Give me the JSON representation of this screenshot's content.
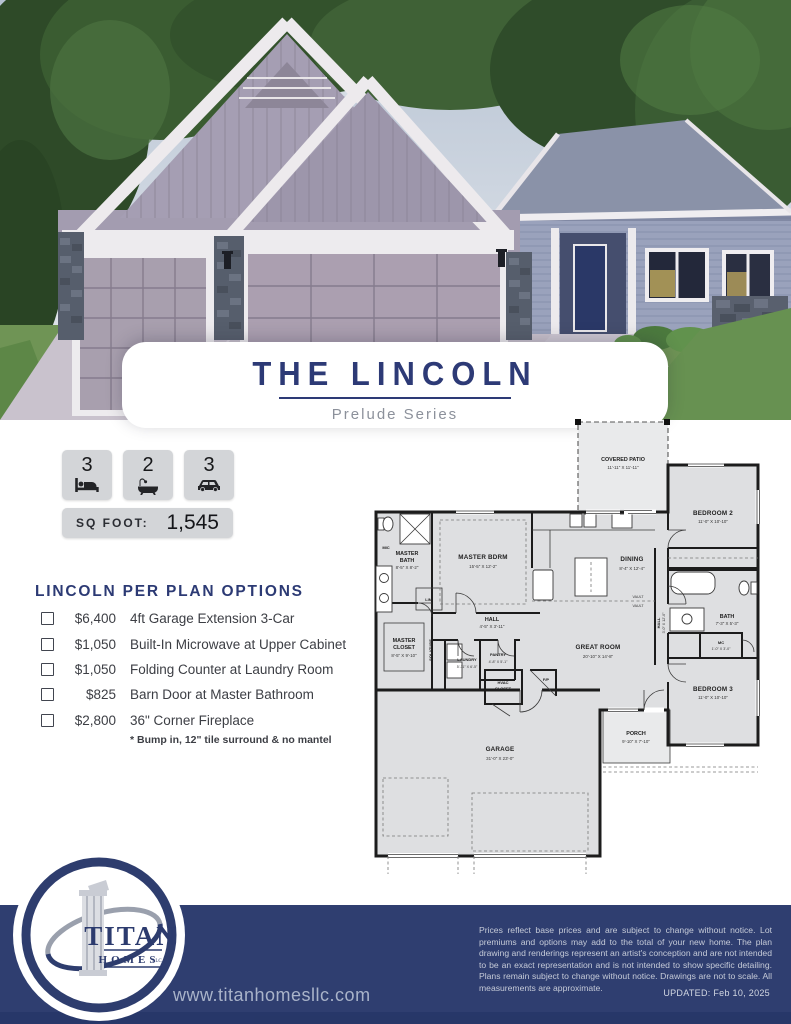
{
  "flyer": {
    "title": "THE LINCOLN",
    "series": "Prelude Series"
  },
  "stats": {
    "beds": "3",
    "baths": "2",
    "garage": "3",
    "beds_icon": "bed-icon",
    "baths_icon": "bath-icon",
    "garage_icon": "car-icon",
    "sqfoot_label": "SQ FOOT:",
    "sqfoot_value": "1,545"
  },
  "options": {
    "heading": "LINCOLN PER PLAN OPTIONS",
    "items": [
      {
        "price": "$6,400",
        "label": "4ft Garage Extension 3-Car"
      },
      {
        "price": "$1,050",
        "label": "Built-In Microwave at Upper Cabinet"
      },
      {
        "price": "$1,050",
        "label": "Folding Counter at Laundry Room"
      },
      {
        "price": "$825",
        "label": "Barn Door at Master Bathroom"
      },
      {
        "price": "$2,800",
        "label": "36\" Corner Fireplace",
        "note": "* Bump in, 12\" tile surround & no mantel"
      }
    ]
  },
  "floorplan": {
    "covered_patio": {
      "name": "COVERED PATIO",
      "dims": "11'-11\" X 11'-11\""
    },
    "bedroom2": {
      "name": "BEDROOM 2",
      "dims": "11'-0\" X 10'-10\""
    },
    "master_bath": {
      "l1": "MASTER",
      "l2": "BATH",
      "dims": "8'-5\" X 8'-2\""
    },
    "master_bdrm": {
      "name": "MASTER BDRM",
      "dims": "15'-5\" X 12'-2\""
    },
    "dining": {
      "name": "DINING",
      "dims": "8'-4\" X 12'-4\""
    },
    "hall": {
      "name": "HALL",
      "dims": "4'-5\" X 3'-11\""
    },
    "master_closet": {
      "l1": "MASTER",
      "l2": "CLOSET",
      "dims": "8'-5\" X 9'-10\""
    },
    "laundry": {
      "name": "LAUNDRY",
      "dims": "5'-11\" X 6'-5\""
    },
    "pantry": {
      "name": "PANTRY",
      "dims": "4'-8\" X 5'-1\""
    },
    "hvac": {
      "l1": "HVAC",
      "l2": "CLOSET"
    },
    "fp": {
      "name": "F/P"
    },
    "solatube": {
      "name": "SOLATUBE"
    },
    "lin": {
      "name": "LIN."
    },
    "mic": {
      "name": "MIC"
    },
    "vault": {
      "name": "VAULT"
    },
    "great_room": {
      "name": "GREAT ROOM",
      "dims": "20'-10\" X 14'-8\""
    },
    "hall2": {
      "name": "HALL",
      "dims": "3'-0\" X 12'-0\""
    },
    "bath": {
      "name": "BATH",
      "dims": "7'-3\" X 5'-3\""
    },
    "mc": {
      "name": "MC",
      "dims": "1'-0\" X 3'-0\""
    },
    "bedroom3": {
      "name": "BEDROOM 3",
      "dims": "11'-0\" X 10'-10\""
    },
    "garage": {
      "name": "GARAGE",
      "dims": "31'-0\" X 23'-0\""
    },
    "porch": {
      "name": "PORCH",
      "dims": "9'-10\" X 7'-10\""
    }
  },
  "footer": {
    "logo_name": "TITAN",
    "logo_sub": "HOMES",
    "logo_llc": "LLC",
    "website": "www.titanhomesllc.com",
    "disclaimer": "Prices reflect base prices and are subject to change without notice. Lot premiums and options may add to the total of your new home. The plan drawing and renderings represent an artist's conception and are not intended to be an exact representation and is not intended to show specific detailing. Plans remain subject to change without notice. Drawings are not to scale. All measurements are approximate.",
    "updated": "UPDATED: Feb 10, 2025"
  },
  "colors": {
    "navy": "#2d3a76",
    "footer_band": "#2f3e70",
    "stat_box": "#d3d5d8",
    "muted_gray": "#8c919b"
  }
}
